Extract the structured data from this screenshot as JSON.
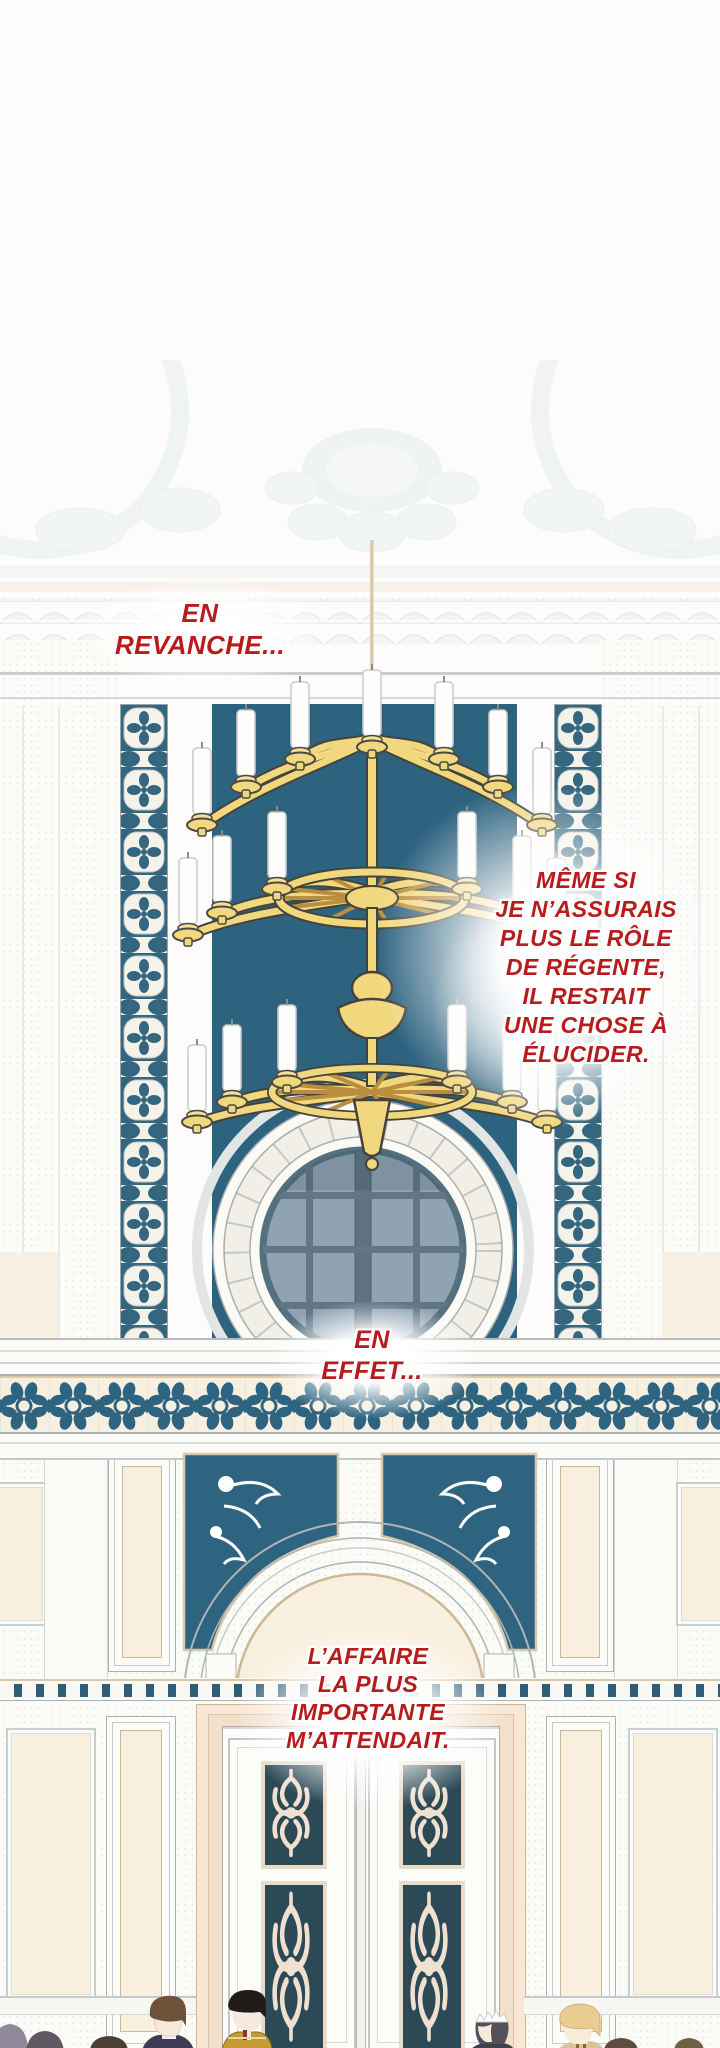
{
  "captions": {
    "revanche": {
      "lines": [
        "EN",
        "REVANCHE..."
      ]
    },
    "regente": {
      "lines": [
        "MÊME SI",
        "JE N’ASSURAIS",
        "PLUS LE RÔLE",
        "DE RÉGENTE,",
        "IL RESTAIT",
        "UNE CHOSE À",
        "ÉLUCIDER."
      ]
    },
    "effet": {
      "lines": [
        "EN",
        "EFFET..."
      ]
    },
    "affaire": {
      "lines": [
        "L’AFFAIRE",
        "LA PLUS",
        "IMPORTANTE",
        "M’ATTENDAIT."
      ]
    }
  },
  "palette": {
    "caption_red": "#B81B1B",
    "chandelier_gold": "#F1D77E",
    "window_teal": "#2E6380",
    "tile_teal": "#34677F",
    "door_panel_teal": "#2B4A55",
    "glass_blue": "#8FA3B2",
    "cream": "#F9EFDE",
    "wall_white": "#FBFBF8"
  },
  "scene": {
    "elements": [
      "palace-hall-interior",
      "gold-chandelier",
      "round-window",
      "mosaic-tile-columns",
      "flower-frieze",
      "arched-doorway",
      "double-doors",
      "crowd-of-figures"
    ]
  }
}
